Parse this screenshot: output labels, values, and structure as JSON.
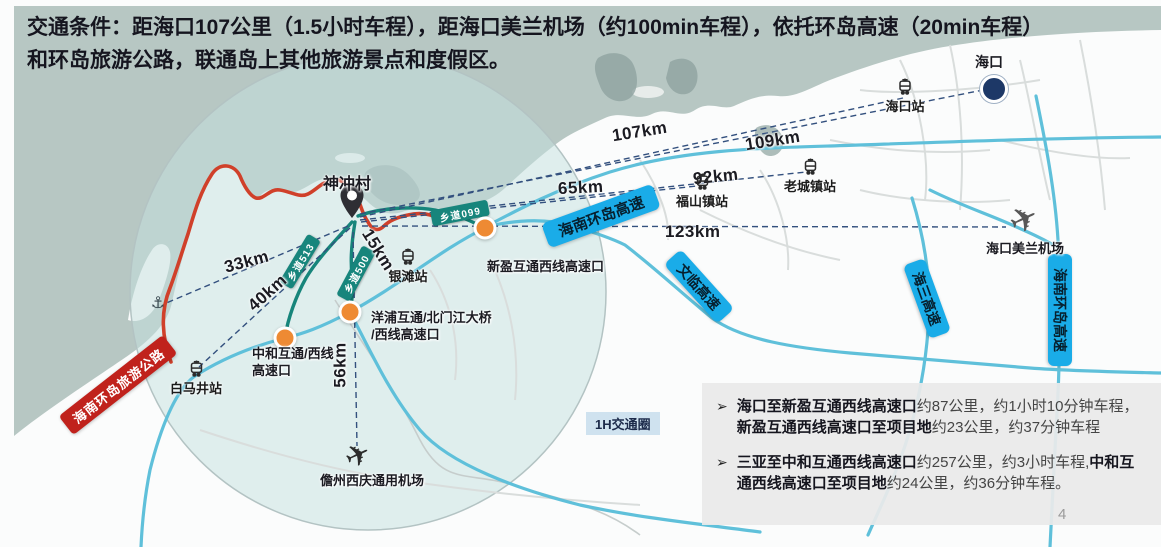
{
  "header": {
    "text": "交通条件：距海口107公里（1.5小时车程），距海口美兰机场（约100min车程），依托环岛高速（20min车程）和环岛旅游公路，联通岛上其他旅游景点和度假区。"
  },
  "map": {
    "city": "海口",
    "village": "神冲村",
    "circle_label": "1H交通圈",
    "stations": [
      {
        "t": "海口站"
      },
      {
        "t": "老城镇站"
      },
      {
        "t": "福山镇站"
      },
      {
        "t": "银滩站"
      },
      {
        "t": "白马井站"
      }
    ],
    "airports": [
      {
        "t": "海口美兰机场"
      },
      {
        "t": "儋州西庆通用机场"
      }
    ],
    "distances": [
      {
        "t": "107km"
      },
      {
        "t": "109km"
      },
      {
        "t": "92km"
      },
      {
        "t": "65km"
      },
      {
        "t": "123km"
      },
      {
        "t": "33km"
      },
      {
        "t": "40km"
      },
      {
        "t": "15km"
      },
      {
        "t": "56km"
      }
    ],
    "highway_banners": [
      {
        "t": "海南环岛高速"
      },
      {
        "t": "文临高速"
      },
      {
        "t": "海三高速"
      },
      {
        "t": "海南环岛高速"
      }
    ],
    "county_road_banners": [
      {
        "t": "乡道099"
      },
      {
        "t": "乡道513"
      },
      {
        "t": "乡道500"
      }
    ],
    "tourist_road_banner": {
      "t": "海南环岛旅游公路"
    },
    "interchanges": [
      {
        "t": "新盈互通西线高速口"
      },
      {
        "t": "中和互通/西线\n高速口"
      },
      {
        "t": "洋浦互通/北门江大桥\n/西线高速口"
      }
    ],
    "icons": {
      "anchor": "⚓",
      "plane": "✈"
    },
    "colors": {
      "sea": "#b7c7c3",
      "highway_banner_blue": "#1aace8",
      "county_road_teal": "#17857c",
      "tourist_road_red": "#c0221c",
      "interchange_orange": "#ee8a33",
      "blue_road": "#5fc0da",
      "red_road": "#d0402a",
      "dashed_line_navy": "#33507e"
    }
  },
  "notes": {
    "marker": "➢",
    "items": [
      {
        "segments": [
          {
            "t": "海口至新盈互通西线高速口"
          },
          {
            "t": "约87公里，约1小时10分钟车程，"
          },
          {
            "t": "新盈互通西线高速口至项目地"
          },
          {
            "t": "约23公里，约37分钟车程"
          }
        ]
      },
      {
        "segments": [
          {
            "t": "三亚至中和互通西线高速口"
          },
          {
            "t": "约257公里，约3小时车程,"
          },
          {
            "t": "中和互通西线高速口至项目地"
          },
          {
            "t": "约24公里，约36分钟车程。"
          }
        ]
      }
    ]
  },
  "footer": {
    "page": "4"
  }
}
